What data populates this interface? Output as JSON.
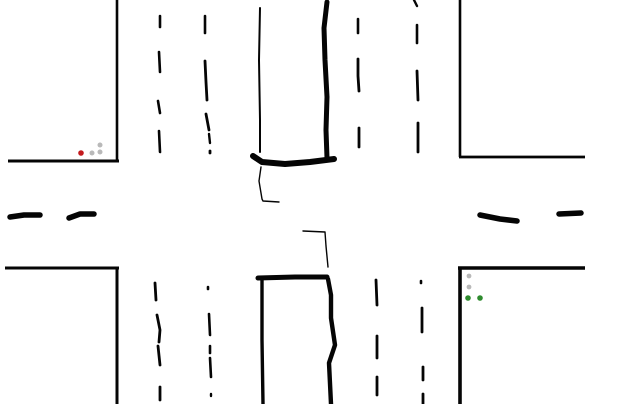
{
  "canvas": {
    "width": 640,
    "height": 404,
    "background": "#ffffff"
  },
  "colors": {
    "ink": "#050505",
    "signal_red": "#c41b1e",
    "signal_green": "#2e8b2e",
    "signal_off": "#b9b9b9"
  },
  "diagram": {
    "road_edges": [
      {
        "name": "road-edge-top-left-vertical",
        "w": 2.6,
        "cap": "butt",
        "points": [
          [
            117,
            0
          ],
          [
            117,
            161
          ]
        ]
      },
      {
        "name": "road-edge-top-left-horizontal",
        "w": 3.0,
        "cap": "butt",
        "points": [
          [
            8,
            161
          ],
          [
            119,
            161
          ]
        ]
      },
      {
        "name": "road-edge-top-right-vertical",
        "w": 2.6,
        "cap": "butt",
        "points": [
          [
            460,
            0
          ],
          [
            460,
            157
          ]
        ]
      },
      {
        "name": "road-edge-top-right-horizontal",
        "w": 2.8,
        "cap": "butt",
        "points": [
          [
            459,
            157
          ],
          [
            585,
            157
          ]
        ]
      },
      {
        "name": "road-edge-bottom-left-horizontal",
        "w": 3.0,
        "cap": "butt",
        "points": [
          [
            5,
            268
          ],
          [
            119,
            268
          ]
        ]
      },
      {
        "name": "road-edge-bottom-left-vertical",
        "w": 3.0,
        "cap": "butt",
        "points": [
          [
            117,
            268
          ],
          [
            117,
            404
          ]
        ]
      },
      {
        "name": "road-edge-bottom-right-horizontal",
        "w": 3.6,
        "cap": "butt",
        "points": [
          [
            458,
            268
          ],
          [
            585,
            268
          ]
        ]
      },
      {
        "name": "road-edge-bottom-right-vertical",
        "w": 3.6,
        "cap": "butt",
        "points": [
          [
            460,
            267
          ],
          [
            460,
            404
          ]
        ]
      }
    ],
    "lane_dashes": [
      {
        "name": "lane-dash-nw-col1-1",
        "w": 2.6,
        "points": [
          [
            160,
            16
          ],
          [
            160,
            27
          ]
        ]
      },
      {
        "name": "lane-dash-nw-col1-2",
        "w": 2.6,
        "points": [
          [
            159,
            52
          ],
          [
            160,
            72
          ]
        ]
      },
      {
        "name": "lane-dash-nw-col1-3",
        "w": 2.6,
        "points": [
          [
            158,
            101
          ],
          [
            160,
            113
          ]
        ]
      },
      {
        "name": "lane-dash-nw-col1-4",
        "w": 2.6,
        "points": [
          [
            159,
            131
          ],
          [
            160,
            152
          ]
        ]
      },
      {
        "name": "lane-dash-nw-col2-1",
        "w": 2.6,
        "points": [
          [
            205,
            16
          ],
          [
            205,
            33
          ]
        ]
      },
      {
        "name": "lane-dash-nw-col2-2",
        "w": 2.8,
        "points": [
          [
            205,
            61
          ],
          [
            206,
            82
          ],
          [
            207,
            100
          ]
        ]
      },
      {
        "name": "lane-dash-nw-col2-3",
        "w": 2.8,
        "points": [
          [
            206,
            114
          ],
          [
            209,
            130
          ]
        ]
      },
      {
        "name": "lane-dash-nw-col2-4",
        "w": 2.4,
        "points": [
          [
            209,
            134
          ],
          [
            210,
            143
          ]
        ]
      },
      {
        "name": "lane-dash-nw-col2-5",
        "w": 2.8,
        "points": [
          [
            210,
            151
          ],
          [
            210,
            153
          ]
        ]
      },
      {
        "name": "lane-dash-ne-col1-1",
        "w": 2.6,
        "points": [
          [
            358,
            19
          ],
          [
            358,
            33
          ]
        ]
      },
      {
        "name": "lane-dash-ne-col1-2",
        "w": 2.8,
        "points": [
          [
            358,
            59
          ],
          [
            358,
            76
          ],
          [
            359,
            91
          ]
        ]
      },
      {
        "name": "lane-dash-ne-col1-3",
        "w": 2.8,
        "points": [
          [
            359,
            128
          ],
          [
            359,
            147
          ]
        ]
      },
      {
        "name": "lane-dash-ne-col2-1",
        "w": 2.4,
        "points": [
          [
            414,
            0
          ],
          [
            417,
            6
          ]
        ]
      },
      {
        "name": "lane-dash-ne-col2-2",
        "w": 2.6,
        "points": [
          [
            417,
            25
          ],
          [
            417,
            43
          ]
        ]
      },
      {
        "name": "lane-dash-ne-col2-3",
        "w": 2.8,
        "points": [
          [
            417,
            71
          ],
          [
            418,
            100
          ]
        ]
      },
      {
        "name": "lane-dash-ne-col2-4",
        "w": 2.8,
        "points": [
          [
            418,
            123
          ],
          [
            418,
            152
          ]
        ]
      },
      {
        "name": "lane-dash-sw-col1-1",
        "w": 2.8,
        "points": [
          [
            155,
            283
          ],
          [
            156,
            300
          ]
        ]
      },
      {
        "name": "lane-dash-sw-col1-2",
        "w": 2.8,
        "points": [
          [
            157,
            315
          ],
          [
            160,
            330
          ],
          [
            159,
            342
          ]
        ]
      },
      {
        "name": "lane-dash-sw-col1-3",
        "w": 2.8,
        "points": [
          [
            158,
            346
          ],
          [
            160,
            365
          ]
        ]
      },
      {
        "name": "lane-dash-sw-col1-4",
        "w": 2.8,
        "points": [
          [
            160,
            387
          ],
          [
            160,
            400
          ]
        ]
      },
      {
        "name": "lane-dash-sw-col2-1",
        "w": 2.6,
        "points": [
          [
            208,
            287
          ],
          [
            208,
            289
          ]
        ]
      },
      {
        "name": "lane-dash-sw-col2-2",
        "w": 2.6,
        "points": [
          [
            209,
            314
          ],
          [
            210,
            335
          ]
        ]
      },
      {
        "name": "lane-dash-sw-col2-3",
        "w": 2.6,
        "points": [
          [
            210,
            346
          ],
          [
            210,
            353
          ]
        ]
      },
      {
        "name": "lane-dash-sw-col2-4",
        "w": 2.6,
        "points": [
          [
            210,
            358
          ],
          [
            211,
            377
          ]
        ]
      },
      {
        "name": "lane-dash-sw-col2-5",
        "w": 2.4,
        "points": [
          [
            211,
            394
          ],
          [
            211,
            396
          ]
        ]
      },
      {
        "name": "lane-dash-se-col1-1",
        "w": 2.8,
        "points": [
          [
            376,
            280
          ],
          [
            377,
            305
          ]
        ]
      },
      {
        "name": "lane-dash-se-col1-2",
        "w": 2.8,
        "points": [
          [
            377,
            336
          ],
          [
            377,
            358
          ]
        ]
      },
      {
        "name": "lane-dash-se-col1-3",
        "w": 2.8,
        "points": [
          [
            377,
            377
          ],
          [
            377,
            395
          ]
        ]
      },
      {
        "name": "lane-dash-se-col2-1",
        "w": 2.6,
        "points": [
          [
            421,
            281
          ],
          [
            421,
            283
          ]
        ]
      },
      {
        "name": "lane-dash-se-col2-2",
        "w": 2.8,
        "points": [
          [
            422,
            308
          ],
          [
            422,
            332
          ]
        ]
      },
      {
        "name": "lane-dash-se-col2-3",
        "w": 2.8,
        "points": [
          [
            423,
            367
          ],
          [
            423,
            380
          ]
        ]
      },
      {
        "name": "lane-dash-se-col2-4",
        "w": 2.8,
        "points": [
          [
            423,
            394
          ],
          [
            423,
            404
          ]
        ]
      }
    ],
    "median_dashes": [
      {
        "name": "median-dash-west-1",
        "w": 5.5,
        "points": [
          [
            10,
            217
          ],
          [
            24,
            215
          ],
          [
            40,
            215
          ]
        ]
      },
      {
        "name": "median-dash-west-2",
        "w": 5.5,
        "points": [
          [
            69,
            218
          ],
          [
            80,
            214
          ],
          [
            94,
            214
          ]
        ]
      },
      {
        "name": "median-dash-east-1",
        "w": 5.5,
        "points": [
          [
            480,
            215
          ],
          [
            500,
            219
          ],
          [
            517,
            221
          ]
        ]
      },
      {
        "name": "median-dash-east-2",
        "w": 5.5,
        "points": [
          [
            559,
            214
          ],
          [
            581,
            213
          ]
        ]
      }
    ],
    "stop_lines": [
      {
        "name": "drawn-curb-top-left-thin",
        "w": 2.0,
        "points": [
          [
            260,
            8
          ],
          [
            259,
            60
          ],
          [
            260,
            120
          ],
          [
            260,
            152
          ]
        ]
      },
      {
        "name": "drawn-stopbar-top-bottom",
        "w": 6.0,
        "points": [
          [
            253,
            156
          ],
          [
            262,
            162
          ],
          [
            285,
            164
          ],
          [
            310,
            162
          ],
          [
            334,
            159
          ]
        ]
      },
      {
        "name": "drawn-curb-top-right-thick",
        "w": 5.0,
        "points": [
          [
            327,
            2
          ],
          [
            324,
            28
          ],
          [
            325,
            60
          ],
          [
            327,
            97
          ],
          [
            326,
            130
          ],
          [
            327,
            158
          ]
        ]
      },
      {
        "name": "drawn-stopbar-bottom-top",
        "w": 5.0,
        "points": [
          [
            258,
            278
          ],
          [
            295,
            277
          ],
          [
            327,
            277
          ]
        ]
      },
      {
        "name": "drawn-curb-bottom-left",
        "w": 3.4,
        "points": [
          [
            262,
            279
          ],
          [
            262,
            340
          ],
          [
            263,
            404
          ]
        ]
      },
      {
        "name": "drawn-curb-bottom-right-wavy",
        "w": 4.4,
        "points": [
          [
            328,
            279
          ],
          [
            331,
            295
          ],
          [
            331,
            318
          ],
          [
            335,
            345
          ],
          [
            329,
            363
          ],
          [
            331,
            404
          ]
        ]
      }
    ],
    "turn_path_lines": [
      {
        "name": "pen-path-upper",
        "w": 1.4,
        "points": [
          [
            261,
            167
          ],
          [
            259,
            181
          ],
          [
            262,
            199
          ],
          [
            263,
            201
          ],
          [
            279,
            202
          ]
        ]
      },
      {
        "name": "pen-path-lower",
        "w": 1.4,
        "points": [
          [
            303,
            231
          ],
          [
            325,
            232
          ],
          [
            326,
            246
          ],
          [
            328,
            267
          ]
        ]
      }
    ],
    "signals": [
      {
        "name": "signal-cluster-top-left",
        "lights": [
          {
            "name": "signal-light-red-on",
            "x": 81,
            "y": 153,
            "r": 2.8,
            "color": "signal_red"
          },
          {
            "name": "signal-light-off-1",
            "x": 92,
            "y": 153,
            "r": 2.5,
            "color": "signal_off"
          },
          {
            "name": "signal-light-off-2",
            "x": 100,
            "y": 145,
            "r": 2.5,
            "color": "signal_off"
          },
          {
            "name": "signal-light-off-3",
            "x": 100,
            "y": 152,
            "r": 2.5,
            "color": "signal_off"
          }
        ]
      },
      {
        "name": "signal-cluster-bottom-right",
        "lights": [
          {
            "name": "signal-light-off-1",
            "x": 469,
            "y": 276,
            "r": 2.4,
            "color": "signal_off"
          },
          {
            "name": "signal-light-off-2",
            "x": 469,
            "y": 287,
            "r": 2.4,
            "color": "signal_off"
          },
          {
            "name": "signal-light-green-on-1",
            "x": 468,
            "y": 298,
            "r": 2.8,
            "color": "signal_green"
          },
          {
            "name": "signal-light-green-on-2",
            "x": 480,
            "y": 298,
            "r": 2.8,
            "color": "signal_green"
          }
        ]
      }
    ]
  }
}
